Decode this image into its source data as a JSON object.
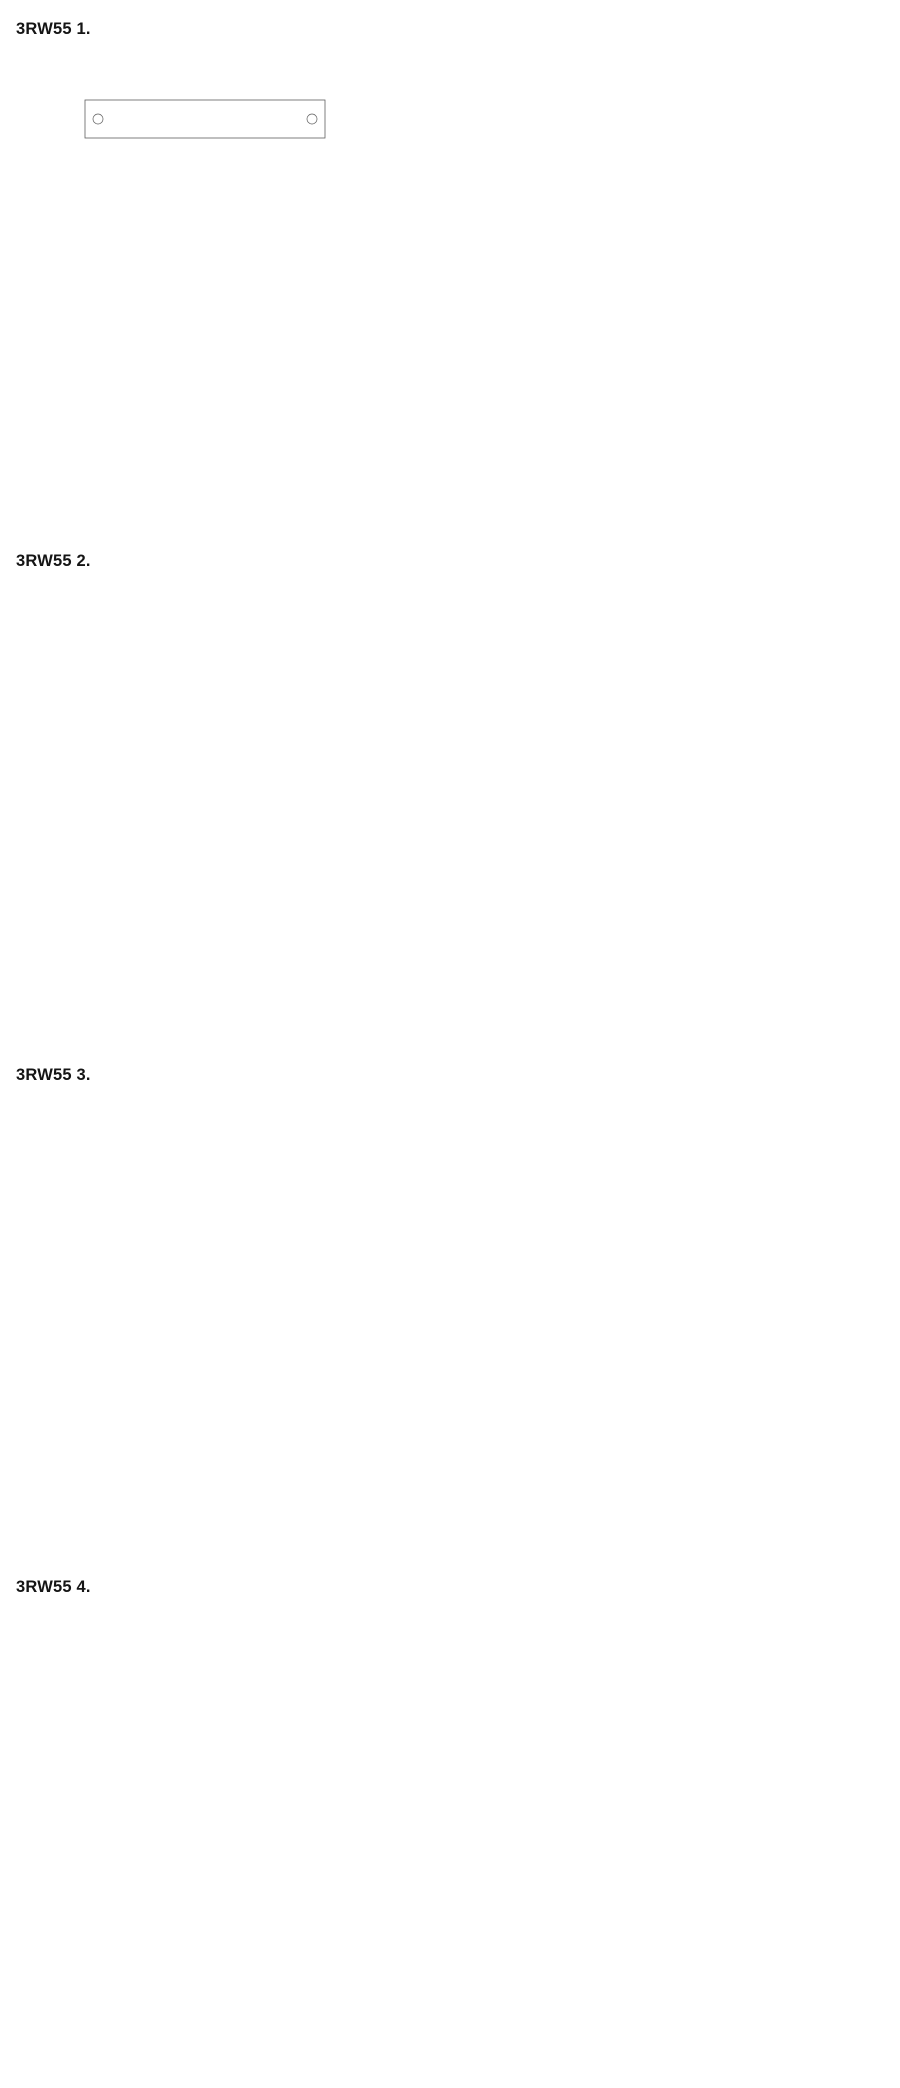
{
  "page": {
    "background": "#ffffff",
    "line_color": "#5f5f5f",
    "dim_line_color": "#7d7d7d",
    "dim_text_color": "#474747",
    "header_text_color": "#151515",
    "sirius_text_color": "#9b9b9b"
  },
  "figures": [
    {
      "title": "3RW55 1.",
      "front": {
        "device_code": "3RW55..-..",
        "brand": "SIEMENS",
        "product_line": "SIRIUS",
        "top_terminals": [
          "1/L1",
          "3/L2",
          "5/L3"
        ],
        "bottom_terminals": [
          "2/T1",
          "4/T2",
          "6/T3"
        ],
        "dims": {
          "top": [
            "170",
            "150",
            "14.4"
          ],
          "hole_callout": "⌀7",
          "center_callout": null,
          "left": [
            "271",
            "251",
            "225"
          ],
          "right": null
        }
      },
      "side": {
        "dims": {
          "top": [
            "152",
            "124.1"
          ],
          "right": "274.8",
          "bottom": [
            "10"
          ]
        }
      }
    },
    {
      "title": "3RW55 2.",
      "front": {
        "device_code": "3RW55..-..",
        "brand": "SIEMENS",
        "product_line": "SIRIUS",
        "top_terminals": [
          "1/L1",
          "3/L2",
          "5/L3"
        ],
        "bottom_terminals": [
          "2/T1",
          "4/T2",
          "6/T3"
        ],
        "dims": {
          "top": [
            "185",
            "165",
            "60"
          ],
          "hole_callout": "⌀7",
          "center_callout": null,
          "left": [
            "305.6",
            "289.1",
            "255.6",
            "225"
          ],
          "right": "299"
        }
      },
      "side": {
        "dims": {
          "top": [
            "203"
          ],
          "right": null,
          "bottom": [
            "10"
          ]
        }
      }
    },
    {
      "title": "3RW55 3.",
      "front": {
        "device_code": "3RW55..-..",
        "brand": "SIEMENS",
        "product_line": "SIRIUS",
        "top_terminals": [
          "1/L1",
          "3/L2",
          "5/L3"
        ],
        "bottom_terminals": [
          "2/T1",
          "4/T2",
          "6/T3"
        ],
        "dims": {
          "top": [
            "185",
            "165",
            "60",
            "17"
          ],
          "hole_callout": "⌀7",
          "center_callout": "⌀8.5",
          "left": [
            "385.6",
            "369.1",
            "255.6",
            "225"
          ],
          "right": "365.6"
        }
      },
      "side": {
        "dims": {
          "top": [
            "203",
            "110"
          ],
          "right": null,
          "bottom": [
            "10",
            "110"
          ]
        }
      }
    },
    {
      "title": "3RW55 4.",
      "front": {
        "device_code": "3RW55..-..",
        "brand": "SIEMENS",
        "product_line": "SIRIUS",
        "top_terminals": [
          "1/L1",
          "3/L2",
          "5/L3"
        ],
        "bottom_terminals": [
          "2/T1",
          "4/T2",
          "6/T3"
        ],
        "dims": {
          "top": [
            "210",
            "182",
            "68.5",
            "85"
          ],
          "hole_callout": "⌀9",
          "center_callout": "⌀11",
          "left": [
            "448.8",
            "432.4",
            "225"
          ],
          "right": "505.3"
        }
      },
      "side": {
        "dims": {
          "top": [
            "282.3",
            "111.5"
          ],
          "right": null,
          "bottom": [
            "12.5",
            "111.5"
          ]
        }
      }
    }
  ],
  "terminal_labels": [
    "T2",
    "T1",
    "DI4",
    "DI3",
    "DI2",
    "DI1",
    "M",
    "L+",
    "AQ L+",
    "AQ D+",
    "AQ -",
    "44",
    "42",
    "98",
    "96",
    "95",
    "24",
    "23",
    "14",
    "13",
    "A2",
    "A1"
  ]
}
